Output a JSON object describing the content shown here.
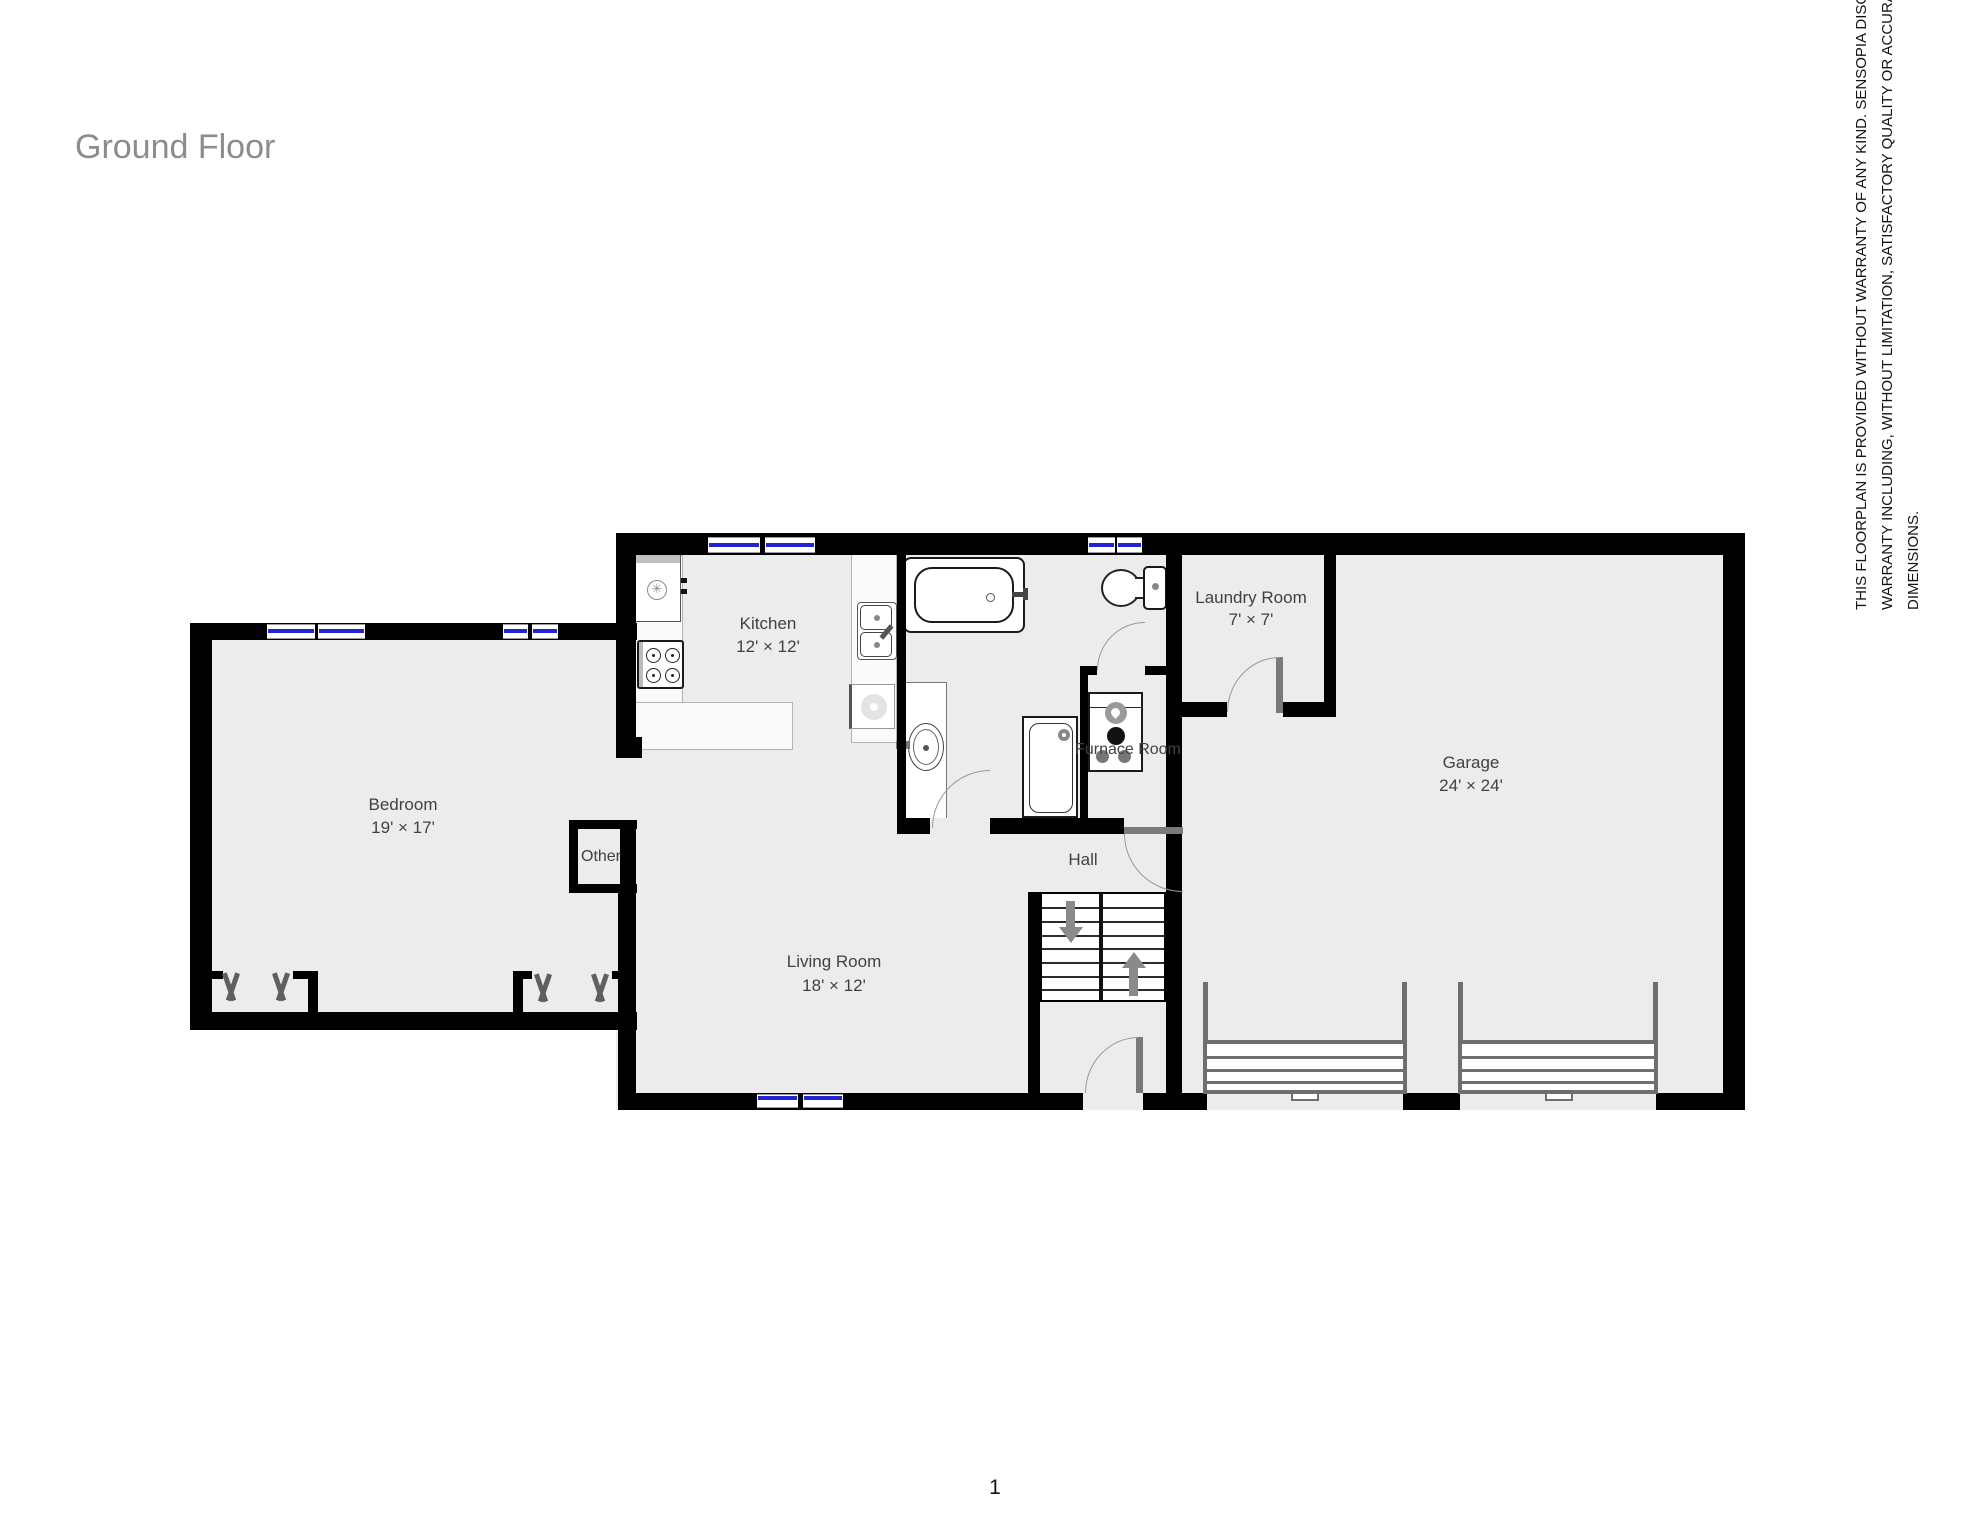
{
  "page": {
    "title": "Ground Floor",
    "page_number": "1"
  },
  "disclaimer": {
    "lines": [
      "THIS FLOORPLAN IS PROVIDED WITHOUT WARRANTY OF ANY KIND. SENSOPIA DISCLAIMS ANY",
      "WARRANTY INCLUDING, WITHOUT LIMITATION, SATISFACTORY QUALITY OR ACCURACY OF",
      "DIMENSIONS."
    ]
  },
  "rooms": {
    "bedroom": {
      "name": "Bedroom",
      "dims": "19' × 17'"
    },
    "kitchen": {
      "name": "Kitchen",
      "dims": "12' × 12'"
    },
    "living_room": {
      "name": "Living Room",
      "dims": "18' × 12'"
    },
    "laundry_room": {
      "name": "Laundry Room",
      "dims": "7' × 7'"
    },
    "garage": {
      "name": "Garage",
      "dims": "24' × 24'"
    },
    "hall": {
      "name": "Hall"
    },
    "furnace_room": {
      "name": "Furnace Room"
    },
    "other": {
      "name": "Other"
    }
  },
  "colors": {
    "wall": "#000000",
    "floor": "#ececec",
    "window_glass": "#2323d6",
    "door": "#7a7a7a",
    "label": "#3d4247",
    "title": "#8c8c8c"
  },
  "icons": [
    "refrigerator-icon",
    "stove-icon",
    "kitchen-sink-icon",
    "dishwasher-icon",
    "bathtub-icon",
    "toilet-icon",
    "vanity-sink-icon",
    "shower-icon",
    "furnace-icon",
    "stairs-up-arrow-icon",
    "stairs-down-arrow-icon",
    "garage-door-icon",
    "closet-rod-icon",
    "door-swing-icon",
    "window-icon"
  ]
}
